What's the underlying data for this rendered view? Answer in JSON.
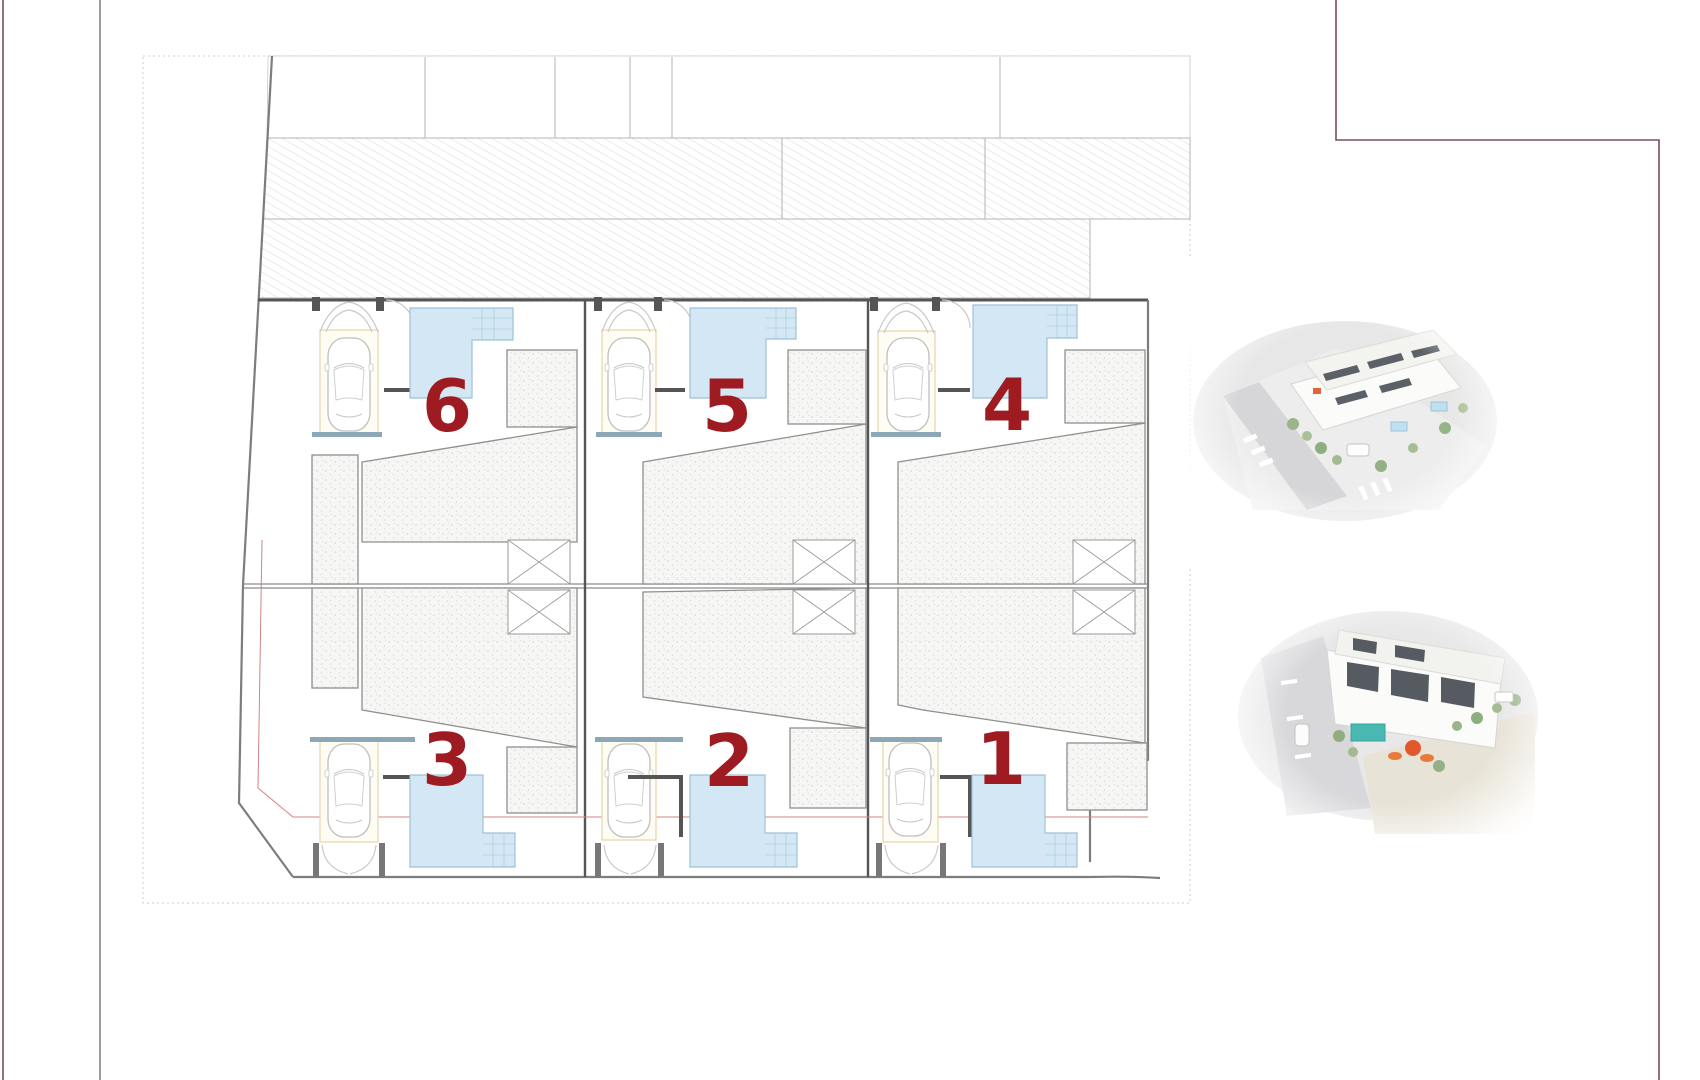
{
  "plan": {
    "title_visible_text": "",
    "units": [
      {
        "id": 6,
        "label": "6",
        "row": "top",
        "position": "left"
      },
      {
        "id": 5,
        "label": "5",
        "row": "top",
        "position": "middle"
      },
      {
        "id": 4,
        "label": "4",
        "row": "top",
        "position": "right"
      },
      {
        "id": 3,
        "label": "3",
        "row": "bottom",
        "position": "left"
      },
      {
        "id": 2,
        "label": "2",
        "row": "bottom",
        "position": "middle"
      },
      {
        "id": 1,
        "label": "1",
        "row": "bottom",
        "position": "right"
      }
    ],
    "colors": {
      "unit_number": "#9e1c21",
      "pool_fill": "#d3e8f4",
      "pool_edge": "#9fc0d5",
      "pergola_band": "#8ca8b6",
      "garage_bay": "#e6d6ad",
      "wall_gray": "#555555",
      "boundary_gray": "#7d7d7d",
      "hatch_line": "#dcdcdc",
      "stipple_dot": "#d2d2ce",
      "frame_maroon": "#7a5057",
      "setback_pink": "#d28383"
    },
    "icons": {
      "car": "car-top-view-icon",
      "pool": "swimming-pool-shape",
      "stair_core": "crossed-box-stair-core",
      "garage_canopy": "canopy-arc",
      "driveway_gate": "double-arc-gate"
    }
  },
  "renders": {
    "top": {
      "alt": "aerial 3D render of white townhouses, street corner with crosswalks"
    },
    "bottom": {
      "alt": "aerial 3D render of white townhouses with pool and orange parasol"
    }
  }
}
